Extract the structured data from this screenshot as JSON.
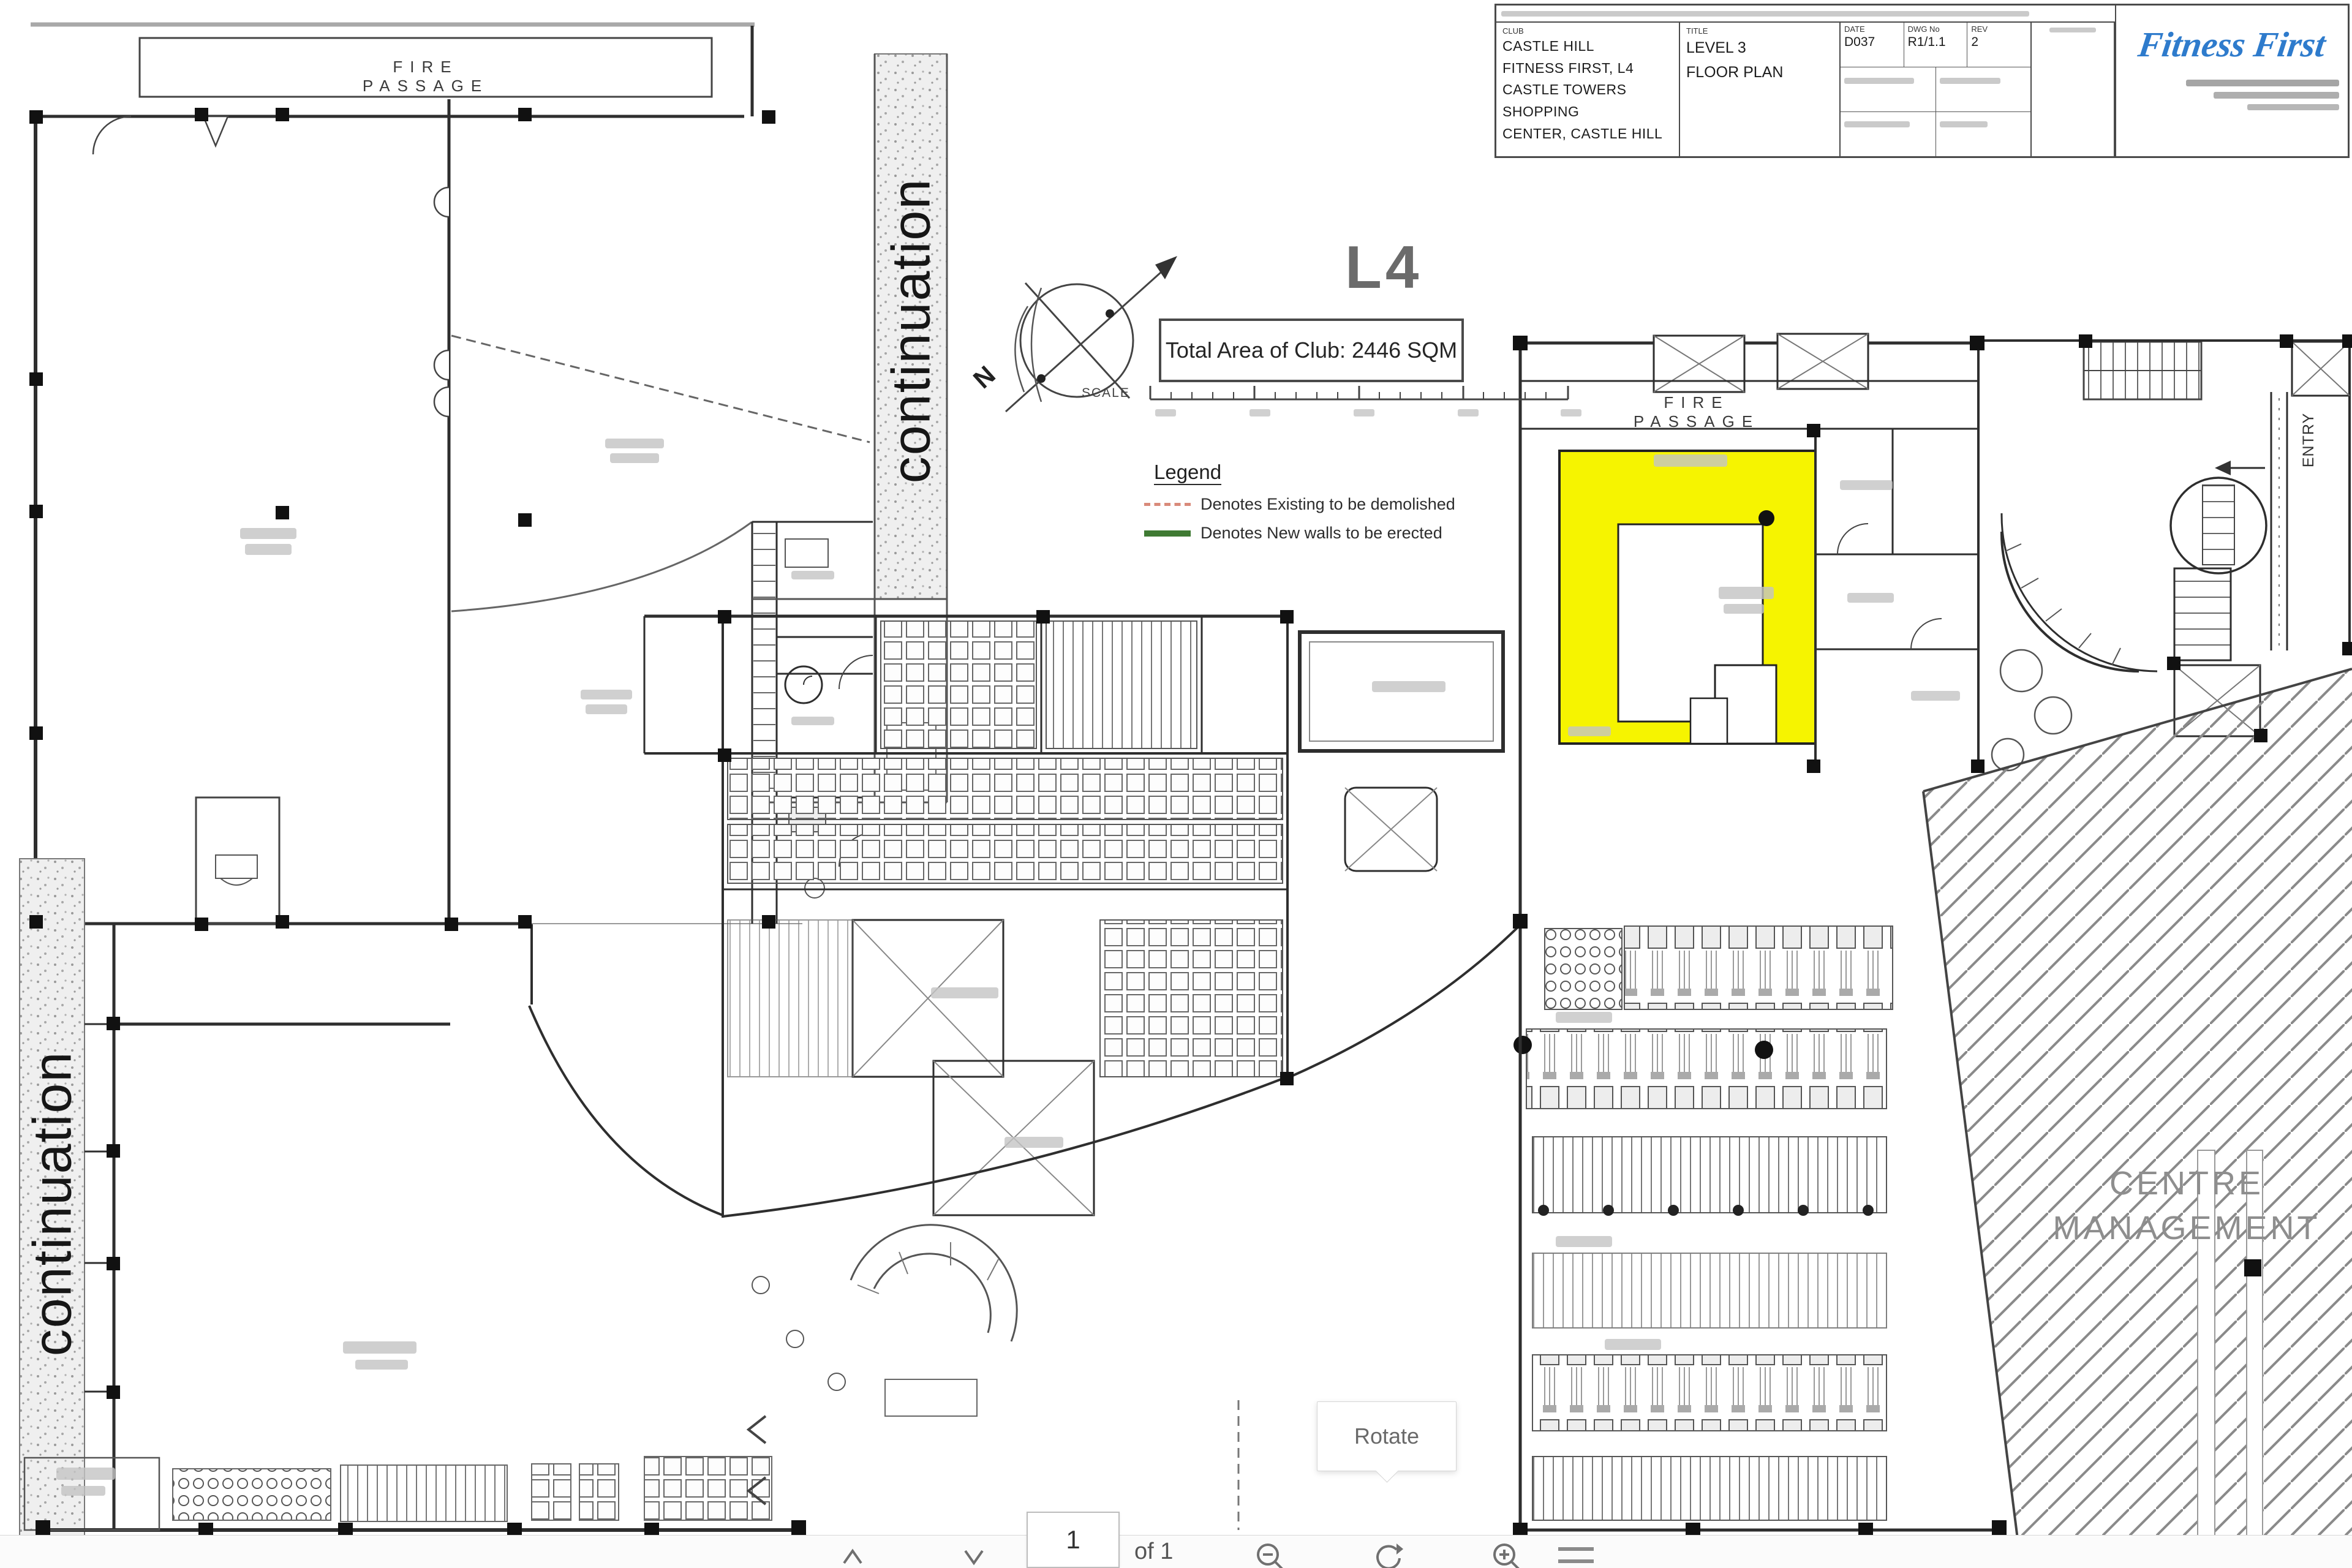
{
  "viewer": {
    "tooltip_rotate": "Rotate",
    "page_number": "1",
    "page_count_label": "of 1"
  },
  "title_block": {
    "club_label": "CLUB",
    "club_line1": "CASTLE HILL",
    "club_line2": "FITNESS FIRST, L4",
    "club_line3": "CASTLE TOWERS SHOPPING",
    "club_line4": "CENTER, CASTLE HILL",
    "title_label": "TITLE",
    "title_line1": "LEVEL 3",
    "title_line2": "FLOOR PLAN",
    "field1_label": "DATE",
    "field1_value": "D037",
    "field2_label": "DWG No",
    "field2_value": "R1/1.1",
    "field3_label": "REV",
    "field3_value": "2",
    "brand": "Fitness First"
  },
  "plan": {
    "fire_passage": "FIRE PASSAGE",
    "continuation": "continuation",
    "centre_line1": "CENTRE",
    "centre_line2": "MANAGEMENT",
    "entry": "ENTRY",
    "level_mark": "L4",
    "total_area": "Total Area of Club: 2446 SQM",
    "scale_label": "SCALE",
    "north": "N"
  },
  "legend": {
    "title": "Legend",
    "item1": "Denotes Existing to be demolished",
    "item2": "Denotes New walls to be erected"
  },
  "colors": {
    "highlight_yellow": "#f6f400",
    "brand_blue": "#2e7bcc"
  }
}
